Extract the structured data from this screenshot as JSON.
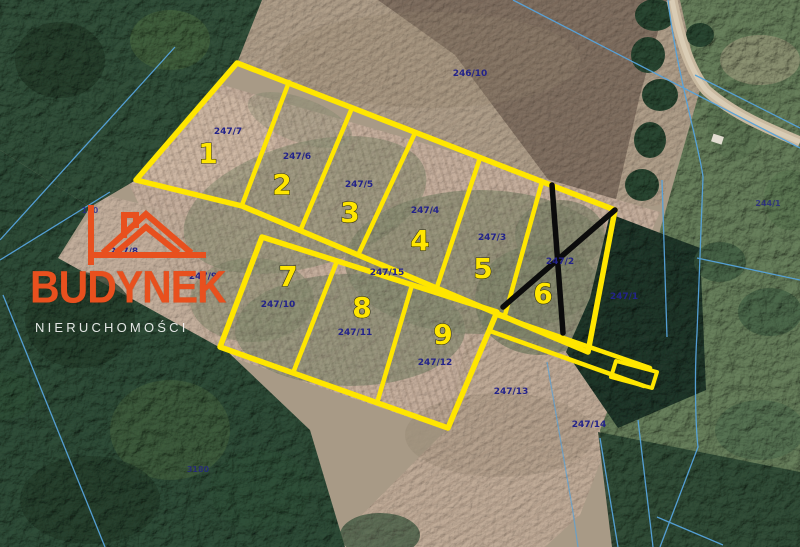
{
  "map": {
    "type": "aerial-cadastral-map",
    "plots": [
      {
        "number": "1",
        "parcel": "247/7"
      },
      {
        "number": "2",
        "parcel": "247/6"
      },
      {
        "number": "3",
        "parcel": "247/5"
      },
      {
        "number": "4",
        "parcel": "247/4"
      },
      {
        "number": "5",
        "parcel": "247/3"
      },
      {
        "number": "6",
        "parcel": "247/2",
        "status": "crossed-out"
      },
      {
        "number": "7",
        "parcel": "247/10"
      },
      {
        "number": "8",
        "parcel": "247/11"
      },
      {
        "number": "9",
        "parcel": "247/12"
      }
    ],
    "other_parcels": {
      "north_field": "246/10",
      "east_of_plot6": "247/1",
      "west_upper": "247/8",
      "west_lower": "247/9",
      "access_strip": "247/15",
      "south_field": "247/13",
      "southeast_forest": "247/14",
      "far_east": "244/1",
      "far_west": "110",
      "southwest_forest": "3180"
    },
    "colors": {
      "plot_outline": "#FFE600",
      "plot_number": "#FFE600",
      "parcel_label": "#23238A",
      "sold_mark": "#0B0B0B",
      "cadastral_line": "#56A3DC",
      "brand": "#E8501E"
    }
  },
  "watermark": {
    "brand": "BUDYNEK",
    "subtitle": "NIERUCHOMOŚCI"
  }
}
